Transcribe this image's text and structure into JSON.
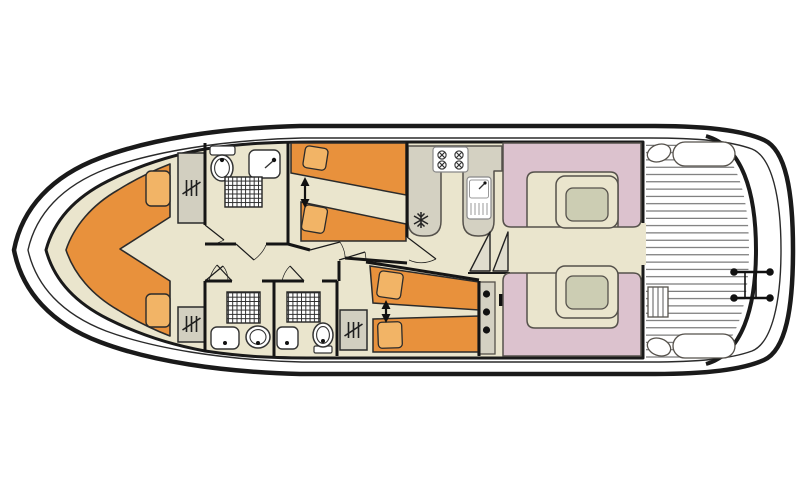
{
  "diagram": {
    "title": "Houseboat interior deck plan, top view",
    "areas": [
      {
        "id": "bow-cabin",
        "features": [
          "v-berth-double-bed",
          "pillow",
          "pillow",
          "wardrobe",
          "wardrobe"
        ]
      },
      {
        "id": "forward-bathroom",
        "features": [
          "toilet",
          "washbasin",
          "shower"
        ]
      },
      {
        "id": "mid-cabin-upper",
        "features": [
          "single-bed",
          "single-bed",
          "adjustable-beds-arrow"
        ]
      },
      {
        "id": "mid-cabin-lower",
        "features": [
          "single-bed",
          "single-bed",
          "adjustable-beds-arrow",
          "wardrobe"
        ]
      },
      {
        "id": "aft-bathroom-left",
        "features": [
          "shower",
          "washbasin",
          "toilet"
        ]
      },
      {
        "id": "aft-bathroom-right",
        "features": [
          "shower",
          "washbasin",
          "toilet"
        ]
      },
      {
        "id": "galley",
        "features": [
          "counter",
          "cooker-4-burner",
          "sink-with-drainer",
          "fridge"
        ]
      },
      {
        "id": "saloon",
        "features": [
          "dinette-seating",
          "dinette-table",
          "dinette-seating",
          "dinette-table",
          "companionway-steps",
          "steps-with-treads"
        ]
      },
      {
        "id": "aft-deck",
        "features": [
          "deck-planking",
          "bench-seat",
          "bench-seat",
          "side-locker",
          "swim-ladder"
        ]
      }
    ],
    "counts": {
      "cabins": 3,
      "bathrooms": 3,
      "dinettes": 2,
      "wardrobes": 3
    }
  },
  "icons": {
    "fridge": "snowflake",
    "cooker": "four-burner-hob",
    "wardrobe": "hanging-rail-strokes",
    "adjustable_beds": "vertical-double-arrow",
    "stairs": "triangle-steps",
    "swim_ladder": "twin-rail-ladder"
  },
  "colors": {
    "line_dark": "#1a1a1a",
    "line_mid": "#55514b",
    "floor": "#eae5cd",
    "bed": "#e8913c",
    "pillow": "#f2b466",
    "seating": "#dcc2ce",
    "table_top": "#cccdb3",
    "counter": "#d4d1c2",
    "wardrobe": "#d2cfc0",
    "stairs": "#e0ddce",
    "hull_fill": "#ffffff"
  }
}
